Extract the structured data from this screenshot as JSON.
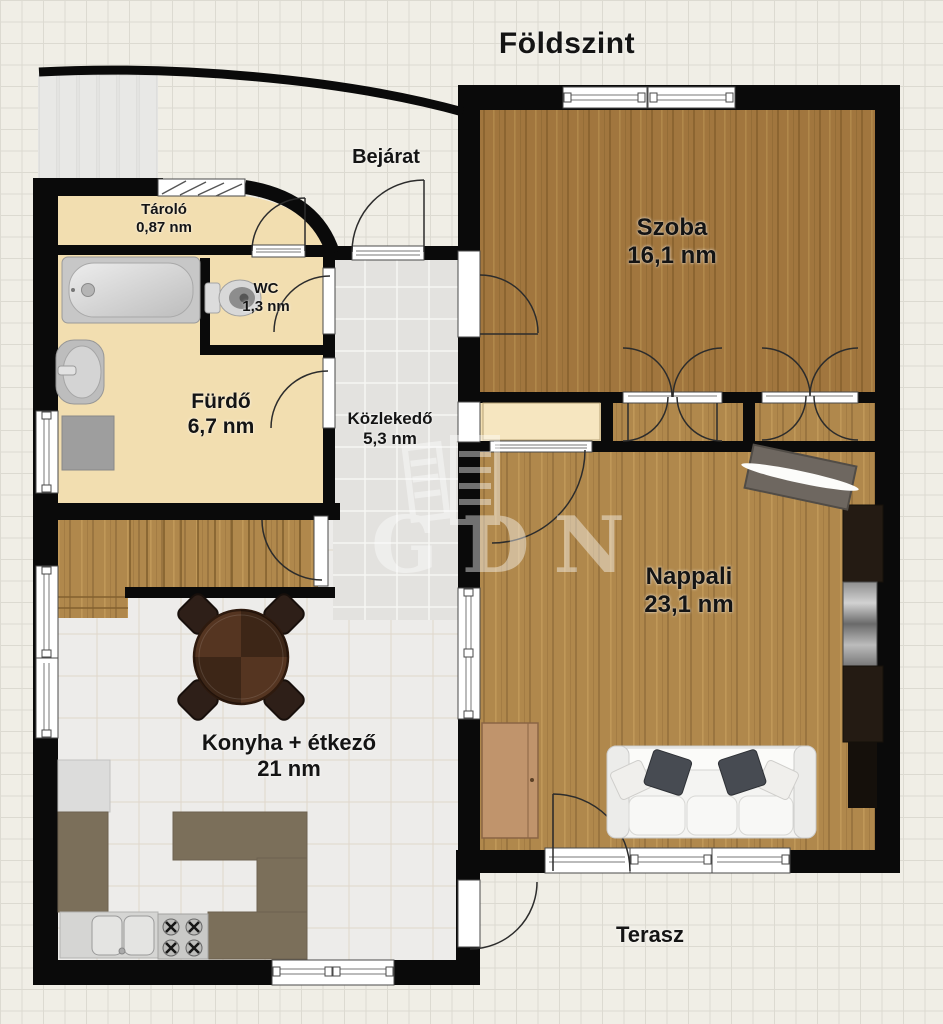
{
  "title": "Földszint",
  "floor_plan": {
    "rooms": [
      {
        "name": "Tároló",
        "area": "0,87 nm"
      },
      {
        "name": "WC",
        "area": "1,3 nm"
      },
      {
        "name": "Fürdő",
        "area": "6,7 nm"
      },
      {
        "name": "Közlekedő",
        "area": "5,3 nm"
      },
      {
        "name": "Szoba",
        "area": "16,1 nm"
      },
      {
        "name": "Nappali",
        "area": "23,1 nm"
      },
      {
        "name": "Konyha + étkező",
        "area": "21 nm"
      }
    ],
    "outdoor_labels": {
      "entrance": "Bejárat",
      "terrace": "Terasz"
    },
    "watermark": "GDN",
    "colors": {
      "wall": "#0a0a0a",
      "room_cream": "#f2deb0",
      "wood_szoba": "#a1763e",
      "wood_nappali": "#b0884c",
      "hall_tile": "#e3e2df",
      "kitchen_tile": "#edecea",
      "counter": "#7b6f5a",
      "background": "#f0eee6"
    }
  }
}
